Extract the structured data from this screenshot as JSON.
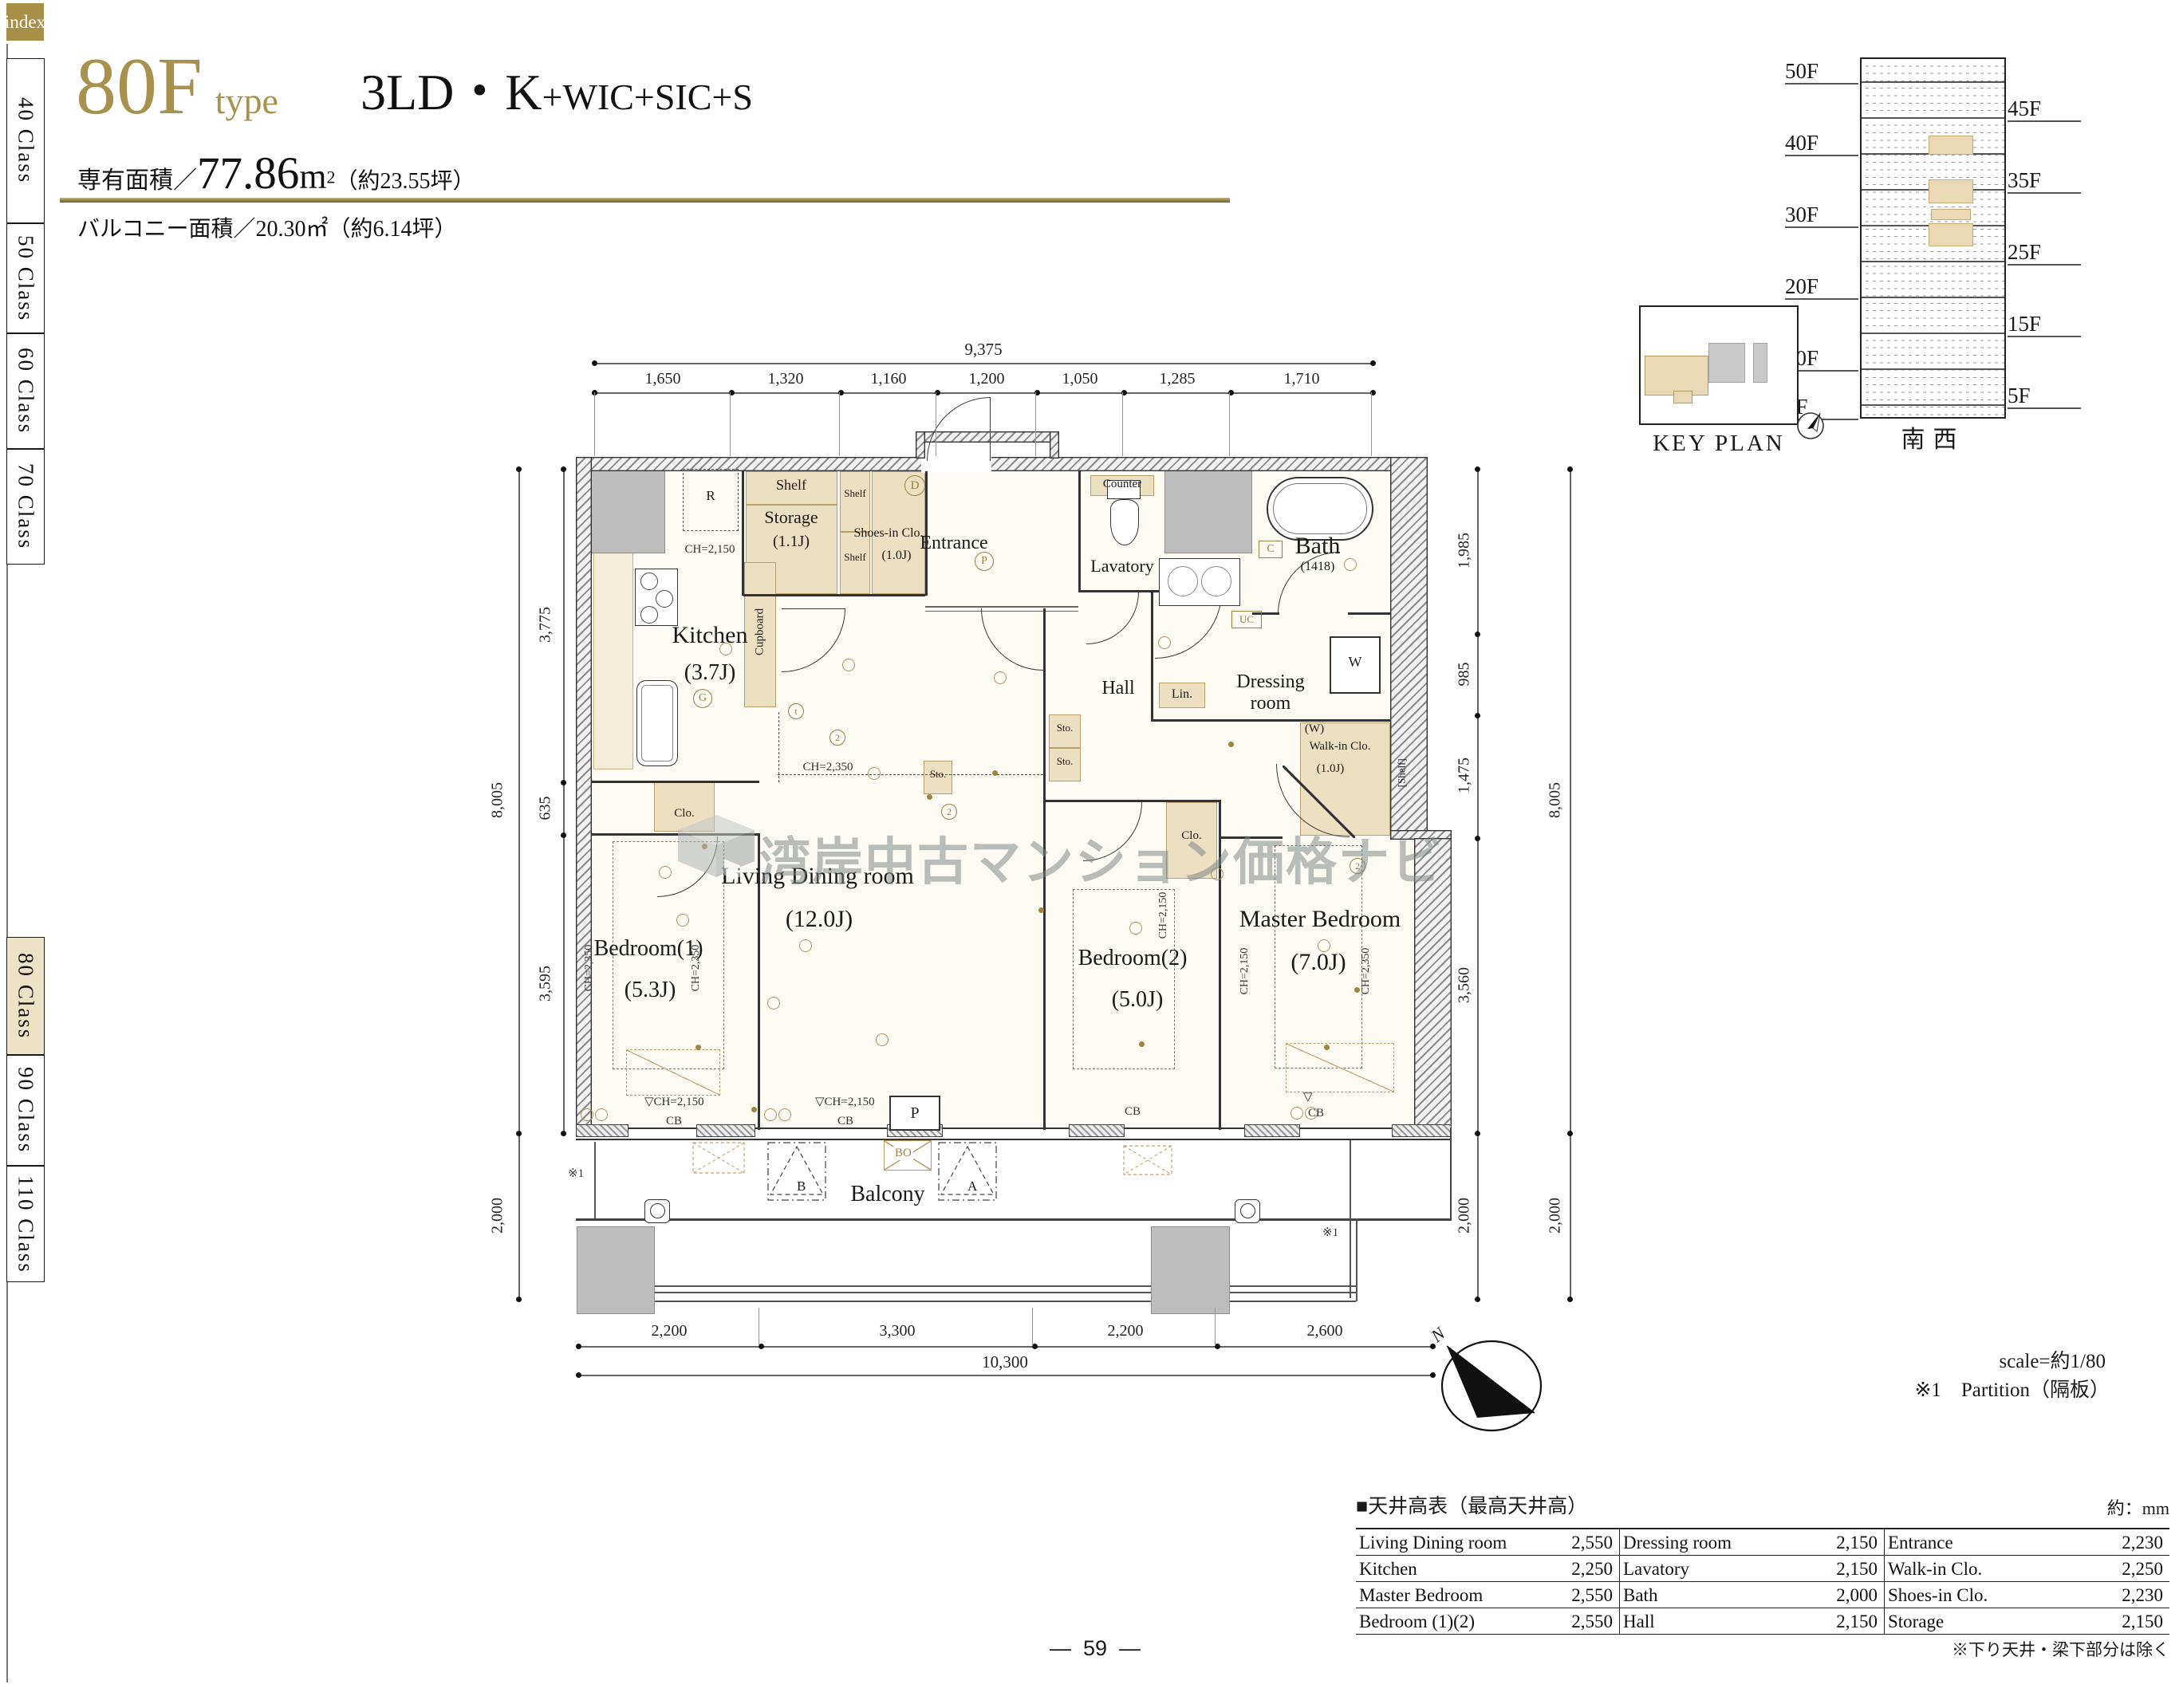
{
  "page": {
    "number": "59",
    "index_label": "index"
  },
  "sidebar": {
    "items": [
      {
        "label": "40 Class"
      },
      {
        "label": "50 Class"
      },
      {
        "label": "60 Class"
      },
      {
        "label": "70 Class"
      },
      {
        "label": "80 Class",
        "active": true
      },
      {
        "label": "90 Class"
      },
      {
        "label": "110 Class"
      }
    ]
  },
  "header": {
    "type_code": "80F",
    "type_word": "type",
    "layout_main": "3LD・K",
    "layout_sub": "+WIC+SIC+S",
    "area_label": "専有面積／",
    "area_value": "77.86",
    "area_unit": "m",
    "area_unit_sup": "2",
    "area_tsubo": "（約23.55坪）",
    "balcony_label": "バルコニー面積／20.30㎡（約6.14坪）"
  },
  "plan": {
    "rooms": {
      "kitchen": {
        "name": "Kitchen",
        "size": "(3.7J)"
      },
      "storage": {
        "name": "Storage",
        "size": "(1.1J)"
      },
      "shoes": {
        "name": "Shoes-in Clo.",
        "size": "(1.0J)"
      },
      "entrance": {
        "name": "Entrance"
      },
      "lavatory": {
        "name": "Lavatory"
      },
      "bath": {
        "name": "Bath",
        "size": "(1418)"
      },
      "dressing": {
        "name": "Dressing room"
      },
      "hall": {
        "name": "Hall"
      },
      "walkin": {
        "name": "Walk-in Clo.",
        "size": "(1.0J)",
        "w": "(W)",
        "shelf": "[Shelf]"
      },
      "living": {
        "name": "Living Dining room",
        "size": "(12.0J)"
      },
      "bedroom1": {
        "name": "Bedroom(1)",
        "size": "(5.3J)"
      },
      "bedroom2": {
        "name": "Bedroom(2)",
        "size": "(5.0J)"
      },
      "master": {
        "name": "Master Bedroom",
        "size": "(7.0J)"
      },
      "balcony": {
        "name": "Balcony"
      }
    },
    "fixtures": {
      "shelf": "Shelf",
      "cupboard": "Cupboard",
      "counter": "Counter",
      "lin": "Lin.",
      "sto": "Sto.",
      "clo": "Clo.",
      "fridge": "R",
      "washer": "W"
    },
    "ch": {
      "high": "CH=2,350",
      "low": "CH=2,150"
    },
    "labels": {
      "cb": "CB",
      "note1": "※1"
    },
    "markers": {
      "d": "D",
      "p": "P",
      "c": "C",
      "uc": "UC",
      "g": "G",
      "t": "t",
      "two": "2",
      "b": "B",
      "a": "A",
      "bo": "BO",
      "n": "N"
    }
  },
  "dims": {
    "top_total": "9,375",
    "top": [
      "1,650",
      "1,320",
      "1,160",
      "1,200",
      "1,050",
      "1,285",
      "1,710"
    ],
    "left": [
      "3,775",
      "635",
      "3,595"
    ],
    "left_total": "8,005",
    "left_balcony": "2,000",
    "right": [
      "1,985",
      "985",
      "1,475",
      "3,560"
    ],
    "right_total": "8,005",
    "right_balcony": "2,000",
    "bottom": [
      "2,200",
      "3,300",
      "2,200",
      "2,600"
    ],
    "bottom_total": "10,300"
  },
  "keyplan": {
    "title": "KEY PLAN",
    "direction": "南西",
    "floors_left": [
      "50F",
      "40F",
      "30F",
      "20F",
      "10F",
      "3F"
    ],
    "floors_right": [
      "45F",
      "35F",
      "25F",
      "15F",
      "5F"
    ]
  },
  "ceiling": {
    "title": "■天井高表（最高天井高）",
    "unit": "約：mm",
    "rows": [
      [
        {
          "n": "Living Dining room",
          "v": "2,550"
        },
        {
          "n": "Dressing room",
          "v": "2,150"
        },
        {
          "n": "Entrance",
          "v": "2,230"
        }
      ],
      [
        {
          "n": "Kitchen",
          "v": "2,250"
        },
        {
          "n": "Lavatory",
          "v": "2,150"
        },
        {
          "n": "Walk-in Clo.",
          "v": "2,250"
        }
      ],
      [
        {
          "n": "Master Bedroom",
          "v": "2,550"
        },
        {
          "n": "Bath",
          "v": "2,000"
        },
        {
          "n": "Shoes-in Clo.",
          "v": "2,230"
        }
      ],
      [
        {
          "n": "Bedroom (1)(2)",
          "v": "2,550"
        },
        {
          "n": "Hall",
          "v": "2,150"
        },
        {
          "n": "Storage",
          "v": "2,150"
        }
      ]
    ],
    "footnote": "※下り天井・梁下部分は除く"
  },
  "notes": {
    "scale": "scale=約1/80",
    "partition": "※1　Partition（隔板）"
  },
  "watermark": {
    "text": "湾岸中古マンション価格ナビ"
  }
}
